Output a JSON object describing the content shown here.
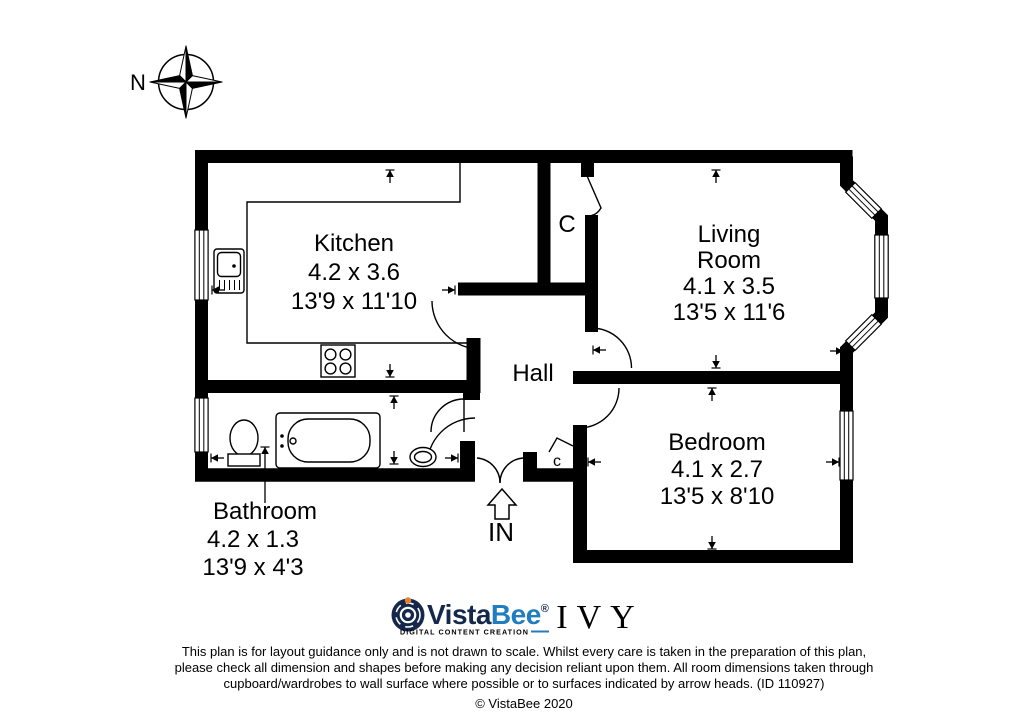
{
  "compass": {
    "label": "N"
  },
  "rooms": {
    "kitchen": {
      "name": "Kitchen",
      "metric": "4.2 x 3.6",
      "imperial": "13'9 x 11'10"
    },
    "living": {
      "name1": "Living",
      "name2": "Room",
      "metric": "4.1 x 3.5",
      "imperial": "13'5 x 11'6"
    },
    "hall": {
      "name": "Hall"
    },
    "bedroom": {
      "name": "Bedroom",
      "metric": "4.1 x 2.7",
      "imperial": "13'5 x 8'10"
    },
    "bathroom": {
      "name": "Bathroom",
      "metric": "4.2 x 1.3",
      "imperial": "13'9 x 4'3"
    }
  },
  "cupboards": {
    "hall_top": "C",
    "entrance": "c"
  },
  "entrance": {
    "label": "IN"
  },
  "branding": {
    "vistabee": {
      "word_part1": "Vista",
      "word_part2": "Bee",
      "registered": "®",
      "tagline": "DIGITAL CONTENT CREATION",
      "navy": "#15284b",
      "blue": "#1f7dc0",
      "accent_orange": "#e87f2f"
    },
    "partner": {
      "name": "IVY",
      "green": "#3e8d55"
    }
  },
  "disclaimer": {
    "line1": "This plan is for layout guidance only and is not drawn to scale. Whilst every care is taken in the preparation of this plan,",
    "line2": "please check all dimension and shapes before making any decision reliant upon them. All room dimensions taken through",
    "line3": "cupboard/wardrobes to wall surface where possible or to surfaces indicated by arrow heads. (ID 110927)",
    "copyright": "© VistaBee 2020"
  }
}
